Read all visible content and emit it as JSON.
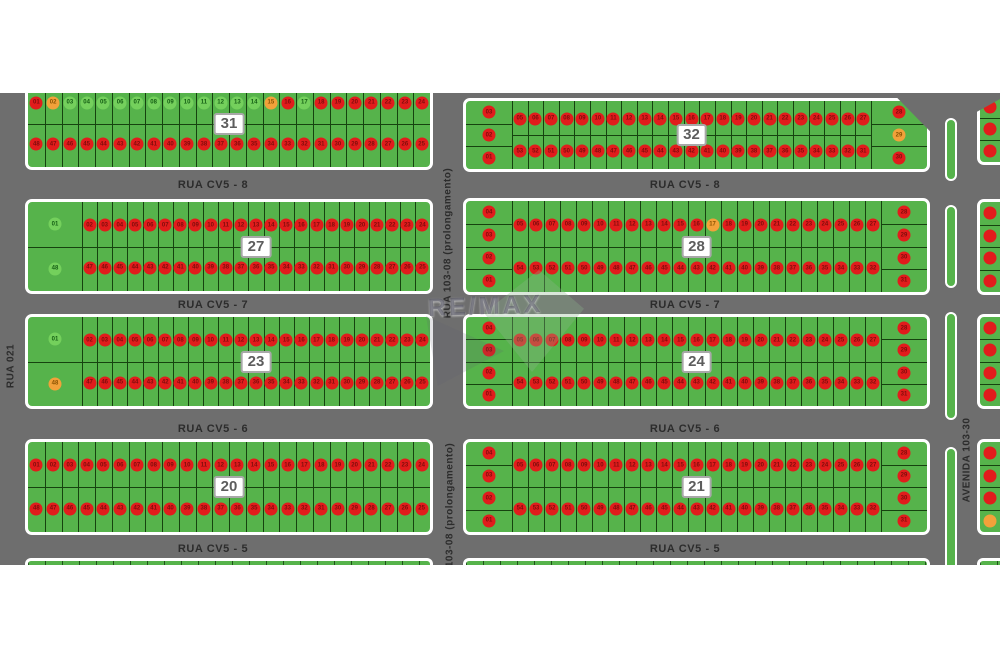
{
  "map": {
    "watermark_text": "RE/MAX",
    "streets": {
      "cv5_8": "RUA CV5 - 8",
      "cv5_7": "RUA CV5 - 7",
      "cv5_6": "RUA CV5 - 6",
      "cv5_5": "RUA CV5 - 5",
      "rua_021": "RUA 021",
      "rua_103_08": "RUA 103-08 (prolongamento)",
      "avenida_103_30": "AVENIDA 103-30"
    },
    "colors": {
      "road": "#6e6e6e",
      "block_green": "#56b34b",
      "lot_line": "#16420f",
      "dot_red": "#e11c1c",
      "dot_orange": "#f2a13a",
      "dot_green": "#74d05c",
      "num_red": "#7f0c0c",
      "num_orange": "#8a5200",
      "num_green": "#155f15",
      "median_green": "#56b34b",
      "white": "#ffffff"
    },
    "blocks": [
      {
        "number": "31",
        "left_col": [],
        "right_col": [],
        "top": {
          "start": 1,
          "end": 24,
          "color": "R",
          "overrides": {
            "2": "O",
            "3": "G",
            "4": "G",
            "5": "G",
            "6": "G",
            "7": "G",
            "8": "G",
            "9": "G",
            "10": "G",
            "11": "G",
            "12": "G",
            "13": "G",
            "14": "G",
            "15": "O",
            "17": "G"
          }
        },
        "bottom": {
          "start": 48,
          "end": 25,
          "color": "R"
        }
      },
      {
        "number": "32",
        "left_col": [
          [
            "03",
            "R"
          ],
          [
            "02",
            "R"
          ],
          [
            "01",
            "R"
          ]
        ],
        "right_col": [
          [
            "28",
            "R"
          ],
          [
            "29",
            "O"
          ],
          [
            "30",
            "R"
          ]
        ],
        "top": {
          "start": 5,
          "end": 27,
          "color": "R"
        },
        "bottom": {
          "start": 53,
          "end": 31,
          "color": "R"
        }
      },
      {
        "number": "27",
        "left_col": [
          [
            "01",
            "G"
          ],
          [
            "48",
            "G"
          ]
        ],
        "right_col": [],
        "top": {
          "start": 2,
          "end": 24,
          "color": "R"
        },
        "bottom": {
          "start": 47,
          "end": 25,
          "color": "R"
        }
      },
      {
        "number": "28",
        "left_col": [
          [
            "04",
            "R"
          ],
          [
            "03",
            "R"
          ],
          [
            "02",
            "R"
          ],
          [
            "01",
            "R"
          ]
        ],
        "right_col": [
          [
            "28",
            "R"
          ],
          [
            "29",
            "R"
          ],
          [
            "30",
            "R"
          ],
          [
            "31",
            "R"
          ]
        ],
        "top": {
          "start": 5,
          "end": 27,
          "color": "R",
          "overrides": {
            "17": "O"
          }
        },
        "bottom": {
          "start": 54,
          "end": 32,
          "color": "R"
        }
      },
      {
        "number": "23",
        "left_col": [
          [
            "01",
            "G"
          ],
          [
            "48",
            "O"
          ]
        ],
        "right_col": [],
        "top": {
          "start": 2,
          "end": 24,
          "color": "R"
        },
        "bottom": {
          "start": 47,
          "end": 25,
          "color": "R"
        }
      },
      {
        "number": "24",
        "left_col": [
          [
            "04",
            "R"
          ],
          [
            "03",
            "R"
          ],
          [
            "02",
            "R"
          ],
          [
            "01",
            "R"
          ]
        ],
        "right_col": [
          [
            "28",
            "R"
          ],
          [
            "29",
            "R"
          ],
          [
            "30",
            "R"
          ],
          [
            "31",
            "R"
          ]
        ],
        "top": {
          "start": 5,
          "end": 27,
          "color": "R"
        },
        "bottom": {
          "start": 54,
          "end": 32,
          "color": "R"
        }
      },
      {
        "number": "20",
        "left_col": [],
        "right_col": [],
        "top": {
          "start": 1,
          "end": 24,
          "color": "R"
        },
        "bottom": {
          "start": 48,
          "end": 25,
          "color": "R"
        }
      },
      {
        "number": "21",
        "left_col": [
          [
            "04",
            "R"
          ],
          [
            "03",
            "R"
          ],
          [
            "02",
            "R"
          ],
          [
            "01",
            "R"
          ]
        ],
        "right_col": [
          [
            "28",
            "R"
          ],
          [
            "29",
            "R"
          ],
          [
            "30",
            "R"
          ],
          [
            "31",
            "R"
          ]
        ],
        "top": {
          "start": 5,
          "end": 27,
          "color": "R"
        },
        "bottom": {
          "start": 54,
          "end": 32,
          "color": "R"
        }
      }
    ],
    "edge_blocks": [
      {
        "dots": [
          "R",
          "R",
          "R"
        ]
      },
      {
        "dots": [
          "R",
          "R",
          "R",
          "R"
        ]
      },
      {
        "dots": [
          "R",
          "R",
          "R",
          "R"
        ]
      },
      {
        "dots": [
          "R",
          "R",
          "R",
          "O"
        ]
      }
    ]
  }
}
